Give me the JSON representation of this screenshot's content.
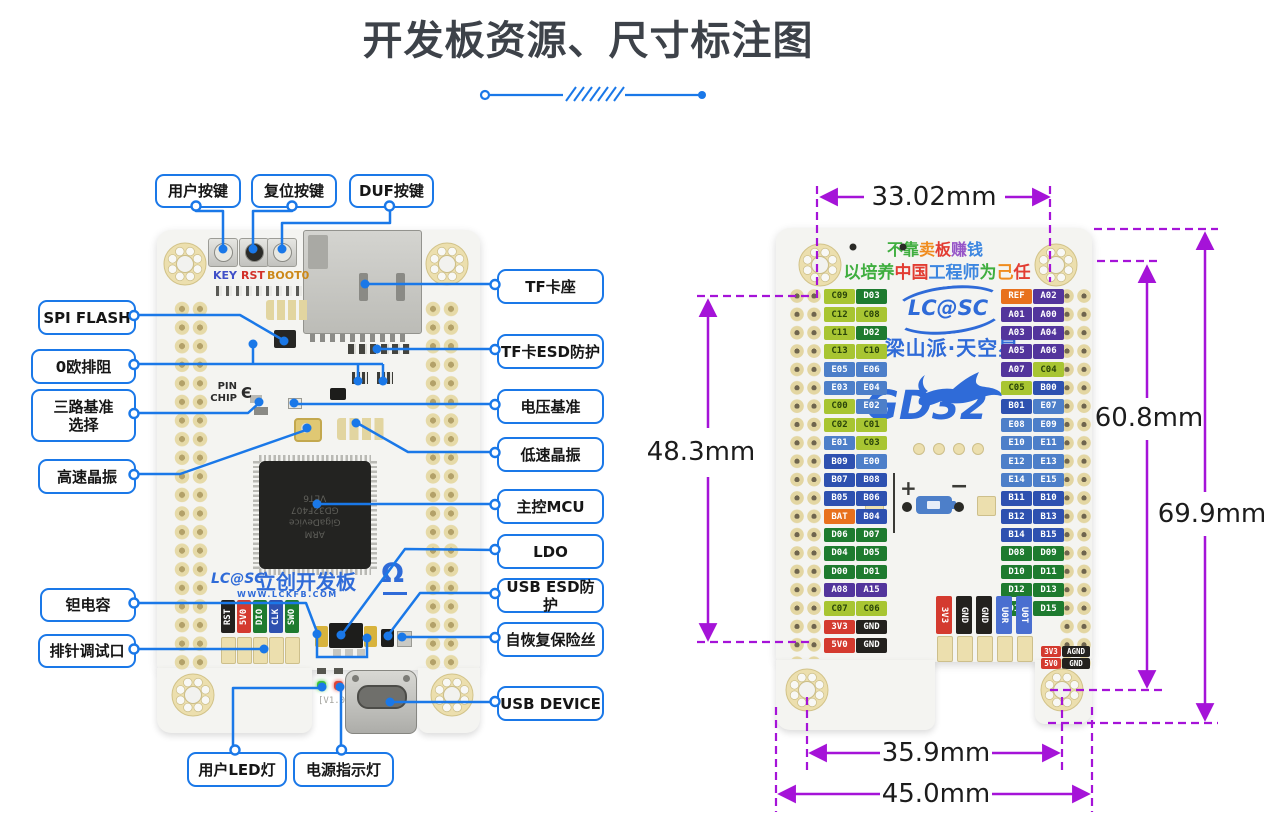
{
  "title": "开发板资源、尺寸标注图",
  "front": {
    "callouts": {
      "yonghu_anjian": "用户按键",
      "fuwei_anjian": "复位按键",
      "duf_anjian": "DUF按键",
      "spi_flash": "SPI FLASH",
      "ou_paizu": "0欧排阻",
      "sanlu_jizhun": "三路基准\n选择",
      "gaosu_jingzhen": "高速晶振",
      "tan_dianrong": "钽电容",
      "paizhen_tiaoshikou": "排针调试口",
      "tf_kazuo": "TF卡座",
      "tf_esd": "TF卡ESD防护",
      "dianya_jizhun": "电压基准",
      "disu_jingzhen": "低速晶振",
      "zhukong_mcu": "主控MCU",
      "ldo": "LDO",
      "usb_esd": "USB ESD防护",
      "zihuifu": "自恢复保险丝",
      "usb_device": "USB DEVICE",
      "yonghu_led": "用户LED灯",
      "dianyuan_led": "电源指示灯"
    },
    "silk": {
      "key": "KEY",
      "rst": "RST",
      "boot": "BOOT0",
      "pin": "PIN",
      "chip": "CHIP",
      "bracket": "Є",
      "logo": "LC@SC",
      "brand": "立创开发板",
      "url": "WWW.LCKFB.COM",
      "version": "[V1.0]",
      "omega": "Ω",
      "mcu_lines": [
        "ARM",
        "GigaDevice",
        "GD32F407",
        "VET6"
      ],
      "debug": [
        {
          "t": "RST",
          "k": "GND"
        },
        {
          "t": "5V0",
          "k": "PWR"
        },
        {
          "t": "DIO",
          "k": "D"
        },
        {
          "t": "CLK",
          "k": "B"
        },
        {
          "t": "SWO",
          "k": "D"
        }
      ]
    }
  },
  "back": {
    "slogan1": [
      {
        "t": "不靠",
        "c": "#3fae3f"
      },
      {
        "t": "卖",
        "c": "#f08c1e"
      },
      {
        "t": "板",
        "c": "#e23c32"
      },
      {
        "t": "赚",
        "c": "#9655c8"
      },
      {
        "t": "钱",
        "c": "#3c86e0"
      }
    ],
    "slogan2": [
      {
        "t": "以培养",
        "c": "#3fae3f"
      },
      {
        "t": "中国",
        "c": "#e23c32"
      },
      {
        "t": "工程师",
        "c": "#3c86e0"
      },
      {
        "t": "为",
        "c": "#3fae3f"
      },
      {
        "t": "己",
        "c": "#f08c1e"
      },
      {
        "t": "任",
        "c": "#e23c32"
      }
    ],
    "logo": "LC@SC",
    "name": "梁山派·天空星",
    "mcu": "GD32",
    "plus": "+",
    "minus": "−",
    "left_rows": [
      [
        [
          "C09",
          "C"
        ],
        [
          "D03",
          "D"
        ]
      ],
      [
        [
          "C12",
          "C"
        ],
        [
          "C08",
          "C"
        ]
      ],
      [
        [
          "C11",
          "C"
        ],
        [
          "D02",
          "D"
        ]
      ],
      [
        [
          "C13",
          "C"
        ],
        [
          "C10",
          "C"
        ]
      ],
      [
        [
          "E05",
          "E"
        ],
        [
          "E06",
          "E"
        ]
      ],
      [
        [
          "E03",
          "E"
        ],
        [
          "E04",
          "E"
        ]
      ],
      [
        [
          "C00",
          "C"
        ],
        [
          "E02",
          "E"
        ]
      ],
      [
        [
          "C02",
          "C"
        ],
        [
          "C01",
          "C"
        ]
      ],
      [
        [
          "E01",
          "E"
        ],
        [
          "C03",
          "C"
        ]
      ],
      [
        [
          "B09",
          "B"
        ],
        [
          "E00",
          "E"
        ]
      ],
      [
        [
          "B07",
          "B"
        ],
        [
          "B08",
          "B"
        ]
      ],
      [
        [
          "B05",
          "B"
        ],
        [
          "B06",
          "B"
        ]
      ],
      [
        [
          "BAT",
          "SPC"
        ],
        [
          "B04",
          "B"
        ]
      ],
      [
        [
          "D06",
          "D"
        ],
        [
          "D07",
          "D"
        ]
      ],
      [
        [
          "D04",
          "D"
        ],
        [
          "D05",
          "D"
        ]
      ],
      [
        [
          "D00",
          "D"
        ],
        [
          "D01",
          "D"
        ]
      ],
      [
        [
          "A08",
          "A"
        ],
        [
          "A15",
          "A"
        ]
      ],
      [
        [
          "C07",
          "C"
        ],
        [
          "C06",
          "C"
        ]
      ],
      [
        [
          "3V3",
          "PWR"
        ],
        [
          "GND",
          "GND"
        ]
      ],
      [
        [
          "5V0",
          "PWR"
        ],
        [
          "GND",
          "GND"
        ]
      ]
    ],
    "right_rows": [
      [
        [
          "REF",
          "SPC"
        ],
        [
          "A02",
          "A"
        ]
      ],
      [
        [
          "A01",
          "A"
        ],
        [
          "A00",
          "A"
        ]
      ],
      [
        [
          "A03",
          "A"
        ],
        [
          "A04",
          "A"
        ]
      ],
      [
        [
          "A05",
          "A"
        ],
        [
          "A06",
          "A"
        ]
      ],
      [
        [
          "A07",
          "A"
        ],
        [
          "C04",
          "C"
        ]
      ],
      [
        [
          "C05",
          "C"
        ],
        [
          "B00",
          "B"
        ]
      ],
      [
        [
          "B01",
          "B"
        ],
        [
          "E07",
          "E"
        ]
      ],
      [
        [
          "E08",
          "E"
        ],
        [
          "E09",
          "E"
        ]
      ],
      [
        [
          "E10",
          "E"
        ],
        [
          "E11",
          "E"
        ]
      ],
      [
        [
          "E12",
          "E"
        ],
        [
          "E13",
          "E"
        ]
      ],
      [
        [
          "E14",
          "E"
        ],
        [
          "E15",
          "E"
        ]
      ],
      [
        [
          "B11",
          "B"
        ],
        [
          "B10",
          "B"
        ]
      ],
      [
        [
          "B12",
          "B"
        ],
        [
          "B13",
          "B"
        ]
      ],
      [
        [
          "B14",
          "B"
        ],
        [
          "B15",
          "B"
        ]
      ],
      [
        [
          "D08",
          "D"
        ],
        [
          "D09",
          "D"
        ]
      ],
      [
        [
          "D10",
          "D"
        ],
        [
          "D11",
          "D"
        ]
      ],
      [
        [
          "D12",
          "D"
        ],
        [
          "D13",
          "D"
        ]
      ],
      [
        [
          "D14",
          "D"
        ],
        [
          "D15",
          "D"
        ]
      ]
    ],
    "bottom_vertical": [
      [
        "3V3",
        "PWR"
      ],
      [
        "GND",
        "GND"
      ],
      [
        "GND",
        "GND"
      ],
      [
        "U0R",
        "UART"
      ],
      [
        "U0T",
        "UART"
      ]
    ],
    "corner_rows": [
      [
        [
          "3V3",
          "PWR"
        ],
        [
          "AGND",
          "GND"
        ]
      ],
      [
        [
          "5V0",
          "PWR"
        ],
        [
          "GND",
          "GND"
        ]
      ]
    ]
  },
  "dimensions": {
    "top": "33.02mm",
    "left": "48.3mm",
    "right_inner": "60.8mm",
    "right_outer": "69.9mm",
    "bottom_inner": "35.9mm",
    "bottom_outer": "45.0mm"
  },
  "colors": {
    "accent_blue": "#1a78e8",
    "dim_purple": "#a513d8",
    "brand_blue": "#2f6bd8",
    "title_gray": "#3d4249",
    "pin": {
      "A": "#53359c",
      "B": "#2e51b0",
      "C": "#a8c532",
      "D": "#1e7b2f",
      "E": "#4d7fc9",
      "PWR": "#d43a2f",
      "GND": "#23211e",
      "SPC": "#e8711d",
      "UART": "#4a6fd0"
    }
  }
}
